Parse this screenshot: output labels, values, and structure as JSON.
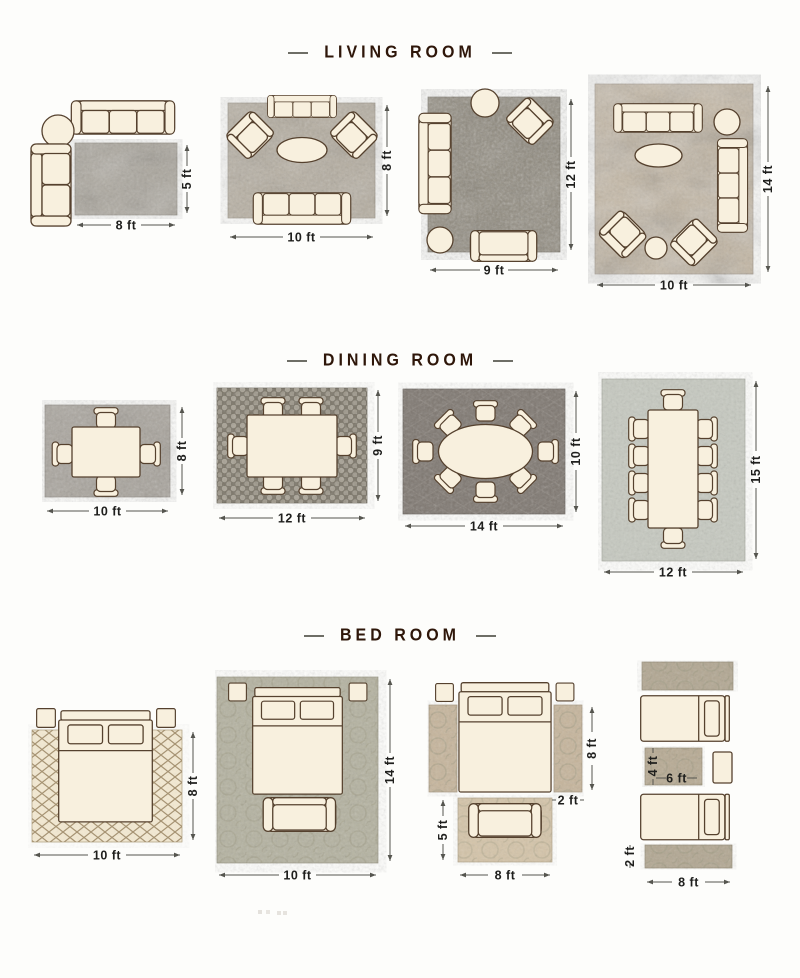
{
  "sections": [
    {
      "title": "LIVING ROOM",
      "layouts": [
        {
          "label_width": "8 ft",
          "label_height": "5 ft"
        },
        {
          "label_width": "10 ft",
          "label_height": "8 ft"
        },
        {
          "label_width": "9 ft",
          "label_height": "12 ft"
        },
        {
          "label_width": "10 ft",
          "label_height": "14 ft"
        }
      ]
    },
    {
      "title": "DINING ROOM",
      "layouts": [
        {
          "label_width": "10 ft",
          "label_height": "8 ft"
        },
        {
          "label_width": "12 ft",
          "label_height": "9 ft"
        },
        {
          "label_width": "14 ft",
          "label_height": "10 ft"
        },
        {
          "label_width": "12 ft",
          "label_height": "15 ft"
        }
      ]
    },
    {
      "title": "BED ROOM",
      "layouts": [
        {
          "label_width": "10 ft",
          "label_height": "8 ft"
        },
        {
          "label_width": "10 ft",
          "label_height": "14 ft"
        },
        {
          "label_runner_height": "8 ft",
          "label_runner_width": "2 ft",
          "label_rug_height": "5 ft",
          "label_rug_width": "8 ft"
        },
        {
          "label_mid_rug_height": "4 ft",
          "label_mid_rug_width": "6 ft",
          "label_runner_height": "2 ft",
          "label_runner_width": "8 ft"
        }
      ]
    }
  ],
  "colors": {
    "background": "#fdfdfb",
    "title_text": "#2e1609",
    "title_dash": "#6e6e66",
    "furniture_fill": "#f8f0de",
    "furniture_outline": "#55412e",
    "dimension_text": "#1f1f1d",
    "dimension_line": "#55554f",
    "rug_lr1": "#aaa59b",
    "rug_lr2": "#b5ad9f",
    "rug_lr3": "#8e887b",
    "rug_lr4": "#c3b6a2",
    "rug_dr1": "#a7a29a",
    "rug_dr2": "#7b7568",
    "rug_dr3": "#7e7770",
    "rug_dr4": "#c6c9c0",
    "rug_br1": "#f3e9d2",
    "rug_br2": "#b4b2a0",
    "rug_br3_runner": "#c6b59c",
    "rug_br3_bottom": "#d4c4a9",
    "rug_br4": "#b2a792"
  }
}
